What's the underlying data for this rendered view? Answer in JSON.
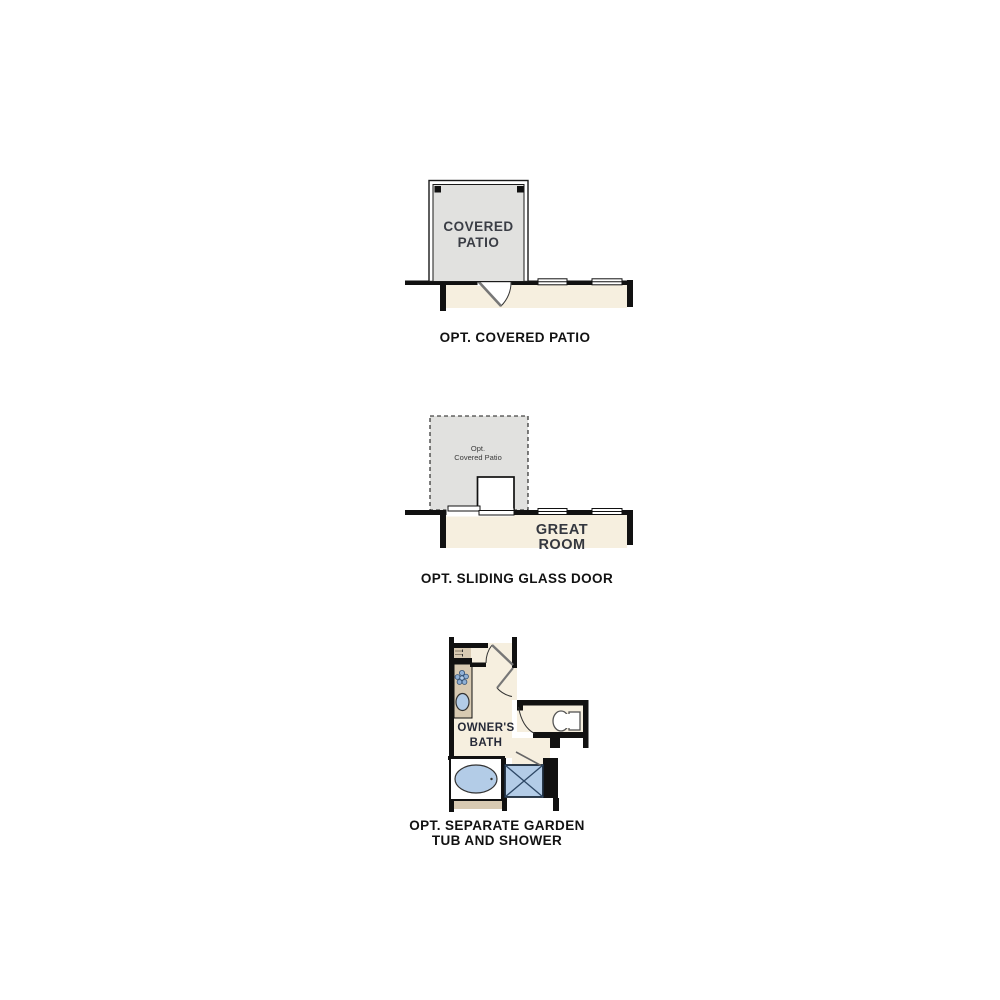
{
  "page": {
    "title": "Floor plan options sheet",
    "background": "#ffffff"
  },
  "colors": {
    "wall": "#111111",
    "patio_fill": "#e1e1df",
    "floor_fill": "#f6efdf",
    "cabinet_fill": "#d8cab2",
    "fixture_fill": "#b3cce7",
    "fixture_stroke": "#2e4866",
    "door_panel": "#777777",
    "caption_text": "#121212",
    "room_label_text": "#3a3d45"
  },
  "figures": [
    {
      "id": "covered-patio",
      "caption": "OPT. COVERED PATIO",
      "labels": {
        "room_line1": "COVERED",
        "room_line2": "PATIO"
      },
      "symbols": [
        "door-swing",
        "window",
        "window",
        "patio-post",
        "patio-post"
      ]
    },
    {
      "id": "sliding-glass-door",
      "caption": "OPT. SLIDING GLASS DOOR",
      "labels": {
        "patio_note_line1": "Opt.",
        "patio_note_line2": "Covered Patio",
        "room_line1": "GREAT",
        "room_line2": "ROOM"
      },
      "symbols": [
        "sliding-door",
        "window",
        "window"
      ]
    },
    {
      "id": "garden-tub-shower",
      "caption_line1": "OPT. SEPARATE GARDEN",
      "caption_line2": "TUB AND SHOWER",
      "labels": {
        "room_line1": "OWNER'S",
        "room_line2": "BATH"
      },
      "symbols": [
        "bathtub",
        "shower",
        "toilet",
        "sink",
        "plant",
        "door-swing",
        "door-swing",
        "linen-shelves"
      ]
    }
  ]
}
